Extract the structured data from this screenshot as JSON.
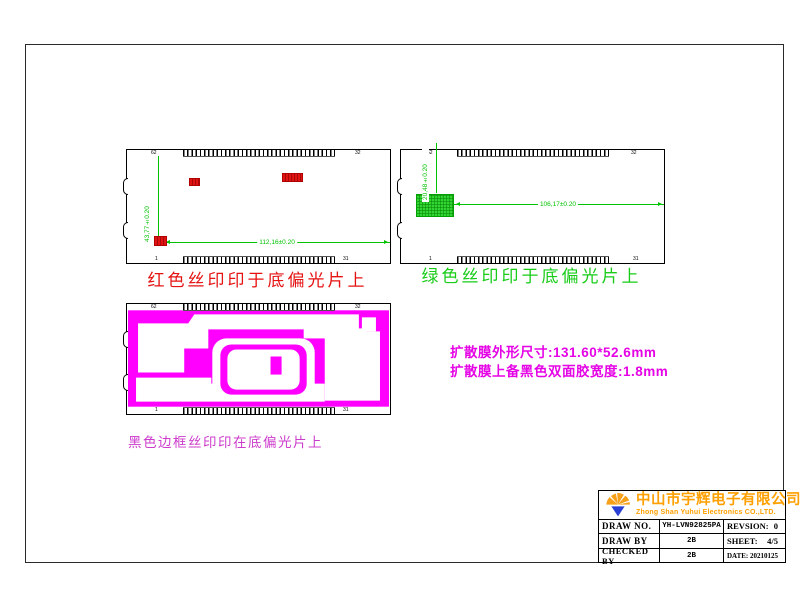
{
  "drawing_red": {
    "corner_labels": {
      "tl": "62",
      "tr": "32",
      "bl": "1",
      "br": "31"
    },
    "dim_vertical": "43,77±0.20",
    "dim_horizontal": "112,16±0.20",
    "caption": "红色丝印印于底偏光片上",
    "color": "#e51212"
  },
  "drawing_green": {
    "corner_labels": {
      "tl": "62",
      "tr": "32",
      "bl": "1",
      "br": "31"
    },
    "dim_vertical": "20,48±0.20",
    "dim_horizontal": "106,17±0.20",
    "caption": "绿色丝印印于底偏光片上",
    "color": "#18cc18"
  },
  "drawing_black_frame": {
    "corner_labels": {
      "tl": "62",
      "tr": "32",
      "bl": "1",
      "br": "31"
    },
    "caption": "黑色边框丝印印在底偏光片上",
    "color": "#ff00ff"
  },
  "notes": {
    "line1": "扩散膜外形尺寸:131.60*52.6mm",
    "line2": "扩散膜上备黑色双面胶宽度:1.8mm",
    "color": "#e504e5"
  },
  "title_block": {
    "company_cn": "中山市宇辉电子有限公司",
    "company_en": "Zhong Shan Yuhui Electronics CO.,LTD.",
    "accent_color": "#ffa000",
    "logo_blue": "#2a3fd4",
    "rows": [
      {
        "label": "DRAW NO.",
        "value": "YH-LVN92825PA",
        "right_label": "REVSION:",
        "right_value": "0"
      },
      {
        "label": "DRAW BY",
        "value": "2B",
        "right_label": "SHEET:",
        "right_value": "4/5"
      },
      {
        "label": "CHECKED BY",
        "value": "2B",
        "right_label": "DATE:",
        "right_value": "20210125"
      }
    ]
  }
}
